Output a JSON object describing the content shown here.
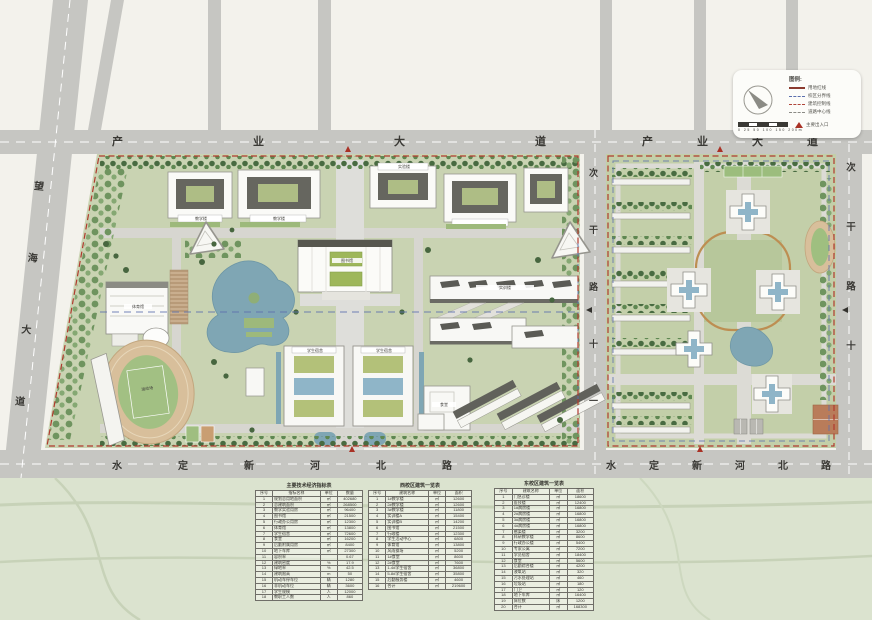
{
  "roads": {
    "top_left": "产业大道",
    "top_right": "产业大道",
    "left_avenue": "望海大道",
    "bottom_left": "水定新河北路",
    "bottom_right": "水定新河北路",
    "middle_vertical": "次干路十一",
    "right_vertical": "次干路十"
  },
  "building_labels": {
    "library": "图书馆",
    "gym": "体育馆",
    "stadium": "运动场",
    "canteen": "食堂",
    "dorm_a": "学生宿舍",
    "dorm_b": "学生宿舍",
    "teach_a": "教学楼",
    "teach_b": "教学楼",
    "lab_a": "实验楼",
    "lab_b": "实训楼"
  },
  "legend": {
    "title": "图例:",
    "items": [
      {
        "style": "solid-maroon",
        "label": "用地红线"
      },
      {
        "style": "dash-blue",
        "label": "校区分界线"
      },
      {
        "style": "dash-red",
        "label": "建筑控制线"
      },
      {
        "style": "dash-gray",
        "label": "道路中心线"
      }
    ],
    "entrance_label": "主要出入口",
    "scale_ticks": "0  25  50  100  150  200m"
  },
  "tables": [
    {
      "name": "economic-indicators-table",
      "title": "主要技术经济指标表",
      "headers": [
        "序号",
        "指标名称",
        "单位",
        "数量"
      ],
      "rows": [
        [
          "1",
          "规划总用地面积",
          "㎡",
          "402680"
        ],
        [
          "2",
          "总建筑面积",
          "㎡",
          "268500"
        ],
        [
          "3",
          "教学实验用房",
          "㎡",
          "96400"
        ],
        [
          "4",
          "图书馆",
          "㎡",
          "21500"
        ],
        [
          "5",
          "行政办公用房",
          "㎡",
          "12300"
        ],
        [
          "6",
          "体育馆",
          "㎡",
          "13800"
        ],
        [
          "7",
          "学生宿舍",
          "㎡",
          "72600"
        ],
        [
          "8",
          "食堂",
          "㎡",
          "16200"
        ],
        [
          "9",
          "后勤附属用房",
          "㎡",
          "8400"
        ],
        [
          "10",
          "地下车库",
          "㎡",
          "27300"
        ],
        [
          "11",
          "容积率",
          "",
          "0.67"
        ],
        [
          "12",
          "建筑密度",
          "%",
          "17.9"
        ],
        [
          "13",
          "绿地率",
          "%",
          "42.5"
        ],
        [
          "14",
          "建筑限高",
          "m",
          "50"
        ],
        [
          "15",
          "机动车停车位",
          "辆",
          "1280"
        ],
        [
          "16",
          "非机动车位",
          "辆",
          "3600"
        ],
        [
          "17",
          "学生规模",
          "人",
          "12000"
        ],
        [
          "18",
          "教职工人数",
          "人",
          "860"
        ]
      ]
    },
    {
      "name": "west-campus-building-table",
      "title": "西校区建筑一览表",
      "headers": [
        "序号",
        "建筑名称",
        "单位",
        "面积"
      ],
      "rows": [
        [
          "1",
          "1#教学楼",
          "㎡",
          "12600"
        ],
        [
          "2",
          "2#教学楼",
          "㎡",
          "12600"
        ],
        [
          "3",
          "3#教学楼",
          "㎡",
          "11800"
        ],
        [
          "4",
          "实训楼A",
          "㎡",
          "15400"
        ],
        [
          "5",
          "实训楼B",
          "㎡",
          "14200"
        ],
        [
          "6",
          "图书馆",
          "㎡",
          "21500"
        ],
        [
          "7",
          "行政楼",
          "㎡",
          "12300"
        ],
        [
          "8",
          "学生活动中心",
          "㎡",
          "6800"
        ],
        [
          "9",
          "体育馆",
          "㎡",
          "13800"
        ],
        [
          "10",
          "风雨操场",
          "㎡",
          "5200"
        ],
        [
          "11",
          "1#食堂",
          "㎡",
          "8600"
        ],
        [
          "12",
          "2#食堂",
          "㎡",
          "7600"
        ],
        [
          "13",
          "1-4#学生宿舍",
          "㎡",
          "36800"
        ],
        [
          "14",
          "5-8#学生宿舍",
          "㎡",
          "35800"
        ],
        [
          "15",
          "后勤服务楼",
          "㎡",
          "4600"
        ],
        [
          "16",
          "合计",
          "㎡",
          "219600"
        ]
      ]
    },
    {
      "name": "east-campus-building-table",
      "title": "东校区建筑一览表",
      "headers": [
        "序号",
        "建筑名称",
        "单位",
        "面积"
      ],
      "rows": [
        [
          "1",
          "门急诊楼",
          "㎡",
          "18600"
        ],
        [
          "2",
          "医技楼",
          "㎡",
          "12400"
        ],
        [
          "3",
          "1#病房楼",
          "㎡",
          "16800"
        ],
        [
          "4",
          "2#病房楼",
          "㎡",
          "16800"
        ],
        [
          "5",
          "3#病房楼",
          "㎡",
          "16800"
        ],
        [
          "6",
          "4#病房楼",
          "㎡",
          "16800"
        ],
        [
          "7",
          "感染楼",
          "㎡",
          "3200"
        ],
        [
          "8",
          "科研教学楼",
          "㎡",
          "8600"
        ],
        [
          "9",
          "行政办公楼",
          "㎡",
          "5400"
        ],
        [
          "10",
          "专家公寓",
          "㎡",
          "7200"
        ],
        [
          "11",
          "学员宿舍",
          "㎡",
          "18400"
        ],
        [
          "12",
          "食堂",
          "㎡",
          "5600"
        ],
        [
          "13",
          "后勤综合楼",
          "㎡",
          "4200"
        ],
        [
          "14",
          "液氧站",
          "㎡",
          "320"
        ],
        [
          "15",
          "污水处理站",
          "㎡",
          "460"
        ],
        [
          "16",
          "垃圾站",
          "㎡",
          "180"
        ],
        [
          "17",
          "门卫",
          "㎡",
          "120"
        ],
        [
          "18",
          "地下车库",
          "㎡",
          "16400"
        ],
        [
          "19",
          "床位数",
          "床",
          "1200"
        ],
        [
          "20",
          "合计",
          "㎡",
          "168300"
        ]
      ]
    }
  ]
}
